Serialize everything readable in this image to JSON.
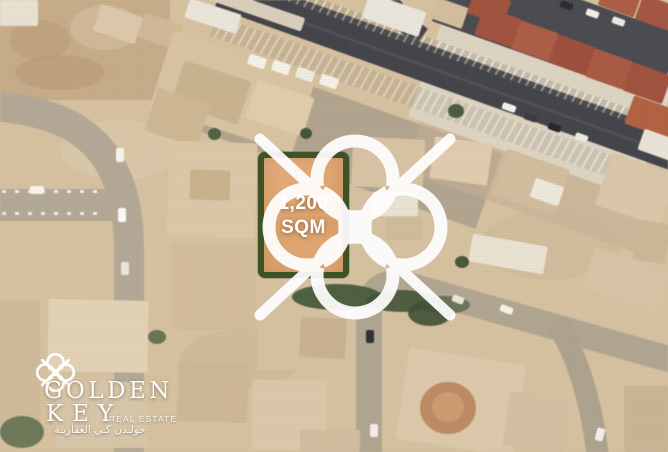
{
  "plot": {
    "area_line1": "1,200",
    "area_line2": "SQM"
  },
  "brand": {
    "name_line1": "GOLDEN",
    "name_line2": "KEY",
    "tagline": "REAL ESTATE",
    "arabic": "جولـدن كـي العقاريـة"
  },
  "colors": {
    "sand": "#d5c09f",
    "plot_fill": "#e1a876",
    "plot_border": "#3d5326",
    "watermark": "#ffffff",
    "text": "#ffffff",
    "road_light": "#b3a893",
    "road_dark": "#434449",
    "roof_red": "#a85540",
    "vegetation": "#4d5f3e"
  },
  "map": {
    "grounds": [
      {
        "t": "rect",
        "x": 0,
        "y": 0,
        "w": 170,
        "h": 100,
        "c": "#c7ab85",
        "n": "dirt-lot"
      },
      {
        "t": "ellipse",
        "x": 10,
        "y": 20,
        "w": 60,
        "h": 40,
        "c": "#bfa077",
        "o": 0.7
      },
      {
        "t": "ellipse",
        "x": 70,
        "y": 5,
        "w": 70,
        "h": 45,
        "c": "#d2bb97",
        "o": 0.8
      },
      {
        "t": "ellipse",
        "x": 15,
        "y": 55,
        "w": 90,
        "h": 35,
        "c": "#b89871",
        "o": 0.5
      },
      {
        "t": "ellipse",
        "x": 60,
        "y": 120,
        "w": 120,
        "h": 60,
        "c": "#dccaaa",
        "o": 0.6
      },
      {
        "t": "ellipse",
        "x": 180,
        "y": 330,
        "w": 120,
        "h": 60,
        "c": "#cbb390",
        "o": 0.5
      },
      {
        "t": "ellipse",
        "x": 480,
        "y": 210,
        "w": 140,
        "h": 70,
        "c": "#cdb896",
        "o": 0.5
      },
      {
        "t": "rect",
        "x": 210,
        "y": 50,
        "w": 310,
        "h": 80,
        "c": "#ab9f8a",
        "r": 19.5,
        "to": "lt",
        "o": 0.85,
        "n": "parking-area"
      },
      {
        "t": "rect",
        "x": 430,
        "y": 95,
        "w": 250,
        "h": 80,
        "c": "#c4b193",
        "r": 19.5,
        "to": "lt",
        "o": 0.6
      },
      {
        "t": "rect",
        "x": 455,
        "y": -15,
        "w": 240,
        "h": 140,
        "c": "#ddd3c0",
        "r": 19.5,
        "to": "lt",
        "n": "compound-ground"
      },
      {
        "t": "rect",
        "x": 455,
        "y": -45,
        "w": 240,
        "h": 70,
        "c": "#4a4b50",
        "r": 19.5,
        "to": "lt",
        "n": "parking-lot-dark"
      }
    ],
    "roads": [
      {
        "d": "M -6 106 C 40 110 86 122 110 164 C 124 189 129 216 129 252 L 129 458",
        "c": "#b3a893",
        "w": 30,
        "n": "curved-street-left"
      },
      {
        "d": "M -4 205 L 118 205",
        "c": "#b3a893",
        "w": 32,
        "n": "street-left-horizontal"
      },
      {
        "d": "M 221 -10 L 702 162",
        "c": "#434449",
        "w": 37,
        "n": "main-road"
      },
      {
        "d": "M 384 -8 C 392 8 404 24 422 37",
        "c": "#44454a",
        "w": 20,
        "n": "main-road-fork"
      },
      {
        "d": "M 240 0 L 700 164",
        "c": "#585960",
        "w": 3,
        "o": 0.6,
        "n": "main-road-wear"
      },
      {
        "d": "M 369 452 L 369 308",
        "c": "#b0a58f",
        "w": 26,
        "n": "street-vertical"
      },
      {
        "d": "M 369 316 C 369 292 380 280 404 284 L 672 360",
        "c": "#b0a58f",
        "w": 26,
        "n": "street-diagonal"
      },
      {
        "d": "M 556 322 C 576 352 592 402 598 458",
        "c": "#ada28c",
        "w": 22,
        "n": "street-branch"
      }
    ],
    "features": [
      {
        "t": "rect",
        "x": 233,
        "y": -32,
        "w": 470,
        "h": 13,
        "r": 19.5,
        "to": "lt",
        "o": 0.75,
        "g": "repeating-linear-gradient(100deg, rgba(255,255,255,0.55) 0 2px, rgba(110,100,85,0.3) 2px 8px)",
        "n": "wall-stripes"
      },
      {
        "t": "rect",
        "x": 217,
        "y": 15,
        "w": 480,
        "h": 22,
        "r": 19.5,
        "to": "lt",
        "o": 0.5,
        "g": "repeating-linear-gradient(100deg, rgba(255,255,255,0.5) 0 2px, rgba(110,100,85,0.3) 2px 8px)",
        "n": "wall-stripes"
      },
      {
        "t": "rect",
        "x": 2,
        "y": 190,
        "w": 100,
        "h": 3,
        "o": 0.8,
        "g": "repeating-linear-gradient(90deg, #ffffff 0 4px, transparent 4px 13px)",
        "n": "parking-dashes"
      },
      {
        "t": "rect",
        "x": 2,
        "y": 212,
        "w": 100,
        "h": 3,
        "o": 0.8,
        "g": "repeating-linear-gradient(90deg, #ffffff 0 4px, transparent 4px 13px)",
        "n": "parking-dashes"
      },
      {
        "t": "rect",
        "x": 0,
        "y": 0,
        "w": 38,
        "h": 26,
        "c": "#e8e1d1",
        "n": "building"
      },
      {
        "t": "rect",
        "x": 96,
        "y": 10,
        "w": 44,
        "h": 28,
        "c": "#dcc7a7",
        "r": 18,
        "n": "building"
      },
      {
        "t": "rect",
        "x": 140,
        "y": 18,
        "w": 40,
        "h": 26,
        "c": "#d0b892",
        "r": 18,
        "n": "building"
      },
      {
        "t": "rect",
        "x": 186,
        "y": 6,
        "w": 54,
        "h": 20,
        "c": "#eae5d8",
        "r": 18,
        "n": "building-shed"
      },
      {
        "t": "rect",
        "x": 196,
        "y": 0,
        "w": 110,
        "h": 14,
        "c": "#d8cdb9",
        "r": 19,
        "n": "building"
      },
      {
        "t": "rect",
        "x": 158,
        "y": 52,
        "w": 150,
        "h": 80,
        "c": "#d8c29e",
        "r": 18,
        "n": "building-compound"
      },
      {
        "t": "rect",
        "x": 176,
        "y": 70,
        "w": 70,
        "h": 45,
        "c": "#c9b28b",
        "r": 18,
        "n": "building"
      },
      {
        "t": "rect",
        "x": 250,
        "y": 88,
        "w": 60,
        "h": 40,
        "c": "#e0cca9",
        "r": 18,
        "n": "building"
      },
      {
        "t": "rect",
        "x": 150,
        "y": 95,
        "w": 55,
        "h": 45,
        "c": "#cfb790",
        "r": 18,
        "n": "building"
      },
      {
        "t": "rect",
        "x": 248,
        "y": 56,
        "w": 18,
        "h": 11,
        "c": "#f3f0e7",
        "r": 19,
        "n": "container"
      },
      {
        "t": "rect",
        "x": 272,
        "y": 62,
        "w": 18,
        "h": 11,
        "c": "#f3f0e7",
        "r": 19,
        "n": "container"
      },
      {
        "t": "rect",
        "x": 296,
        "y": 69,
        "w": 18,
        "h": 11,
        "c": "#eeebe0",
        "r": 19,
        "n": "container"
      },
      {
        "t": "rect",
        "x": 320,
        "y": 76,
        "w": 18,
        "h": 11,
        "c": "#f3f0e7",
        "r": 19,
        "n": "container"
      },
      {
        "t": "rect",
        "x": 364,
        "y": 2,
        "w": 60,
        "h": 26,
        "c": "#e9e5d9",
        "r": 19,
        "n": "building-warehouse"
      },
      {
        "t": "rect",
        "x": 432,
        "y": 2,
        "w": 34,
        "h": 22,
        "c": "#d3bd9c",
        "r": 19,
        "n": "building"
      },
      {
        "t": "rect",
        "x": 470,
        "y": -6,
        "w": 38,
        "h": 26,
        "c": "#a5513b",
        "r": 19.5,
        "n": "roof"
      },
      {
        "t": "rect",
        "x": 478,
        "y": 12,
        "w": 40,
        "h": 30,
        "c": "#a5513b",
        "r": 19.5,
        "n": "roof"
      },
      {
        "t": "rect",
        "x": 515,
        "y": 26,
        "w": 40,
        "h": 30,
        "c": "#b05c42",
        "r": 19.5,
        "n": "roof"
      },
      {
        "t": "rect",
        "x": 552,
        "y": 40,
        "w": 40,
        "h": 30,
        "c": "#a24e38",
        "r": 19.5,
        "n": "roof"
      },
      {
        "t": "rect",
        "x": 589,
        "y": 54,
        "w": 40,
        "h": 30,
        "c": "#ad5840",
        "r": 19.5,
        "n": "roof"
      },
      {
        "t": "rect",
        "x": 626,
        "y": 68,
        "w": 42,
        "h": 30,
        "c": "#a5513b",
        "r": 19.5,
        "n": "roof"
      },
      {
        "t": "rect",
        "x": 601,
        "y": -14,
        "w": 38,
        "h": 26,
        "c": "#b05c42",
        "r": 19.5,
        "n": "roof"
      },
      {
        "t": "rect",
        "x": 638,
        "y": 0,
        "w": 38,
        "h": 26,
        "c": "#a85540",
        "r": 19.5,
        "n": "roof"
      },
      {
        "t": "rect",
        "x": 628,
        "y": 102,
        "w": 46,
        "h": 30,
        "c": "#b5603f",
        "r": 19.5,
        "n": "roof"
      },
      {
        "t": "rect",
        "x": 640,
        "y": 134,
        "w": 36,
        "h": 22,
        "c": "#e8e3d6",
        "r": 19.5,
        "n": "building"
      },
      {
        "t": "rect",
        "x": 432,
        "y": 140,
        "w": 58,
        "h": 42,
        "c": "#e0cbab",
        "r": 8,
        "n": "building"
      },
      {
        "t": "rect",
        "x": 498,
        "y": 158,
        "w": 66,
        "h": 48,
        "c": "#d2bc9b",
        "r": 19,
        "n": "building"
      },
      {
        "t": "rect",
        "x": 532,
        "y": 182,
        "w": 30,
        "h": 20,
        "c": "#ece7db",
        "r": 19,
        "n": "building"
      },
      {
        "t": "rect",
        "x": 602,
        "y": 162,
        "w": 68,
        "h": 55,
        "c": "#dac5a5",
        "r": 19,
        "n": "building"
      },
      {
        "t": "rect",
        "x": 636,
        "y": 222,
        "w": 32,
        "h": 40,
        "c": "#cdb694",
        "r": 10,
        "n": "building"
      },
      {
        "t": "rect",
        "x": 352,
        "y": 138,
        "w": 72,
        "h": 50,
        "c": "#d8c2a1",
        "r": 3,
        "n": "building"
      },
      {
        "t": "rect",
        "x": 372,
        "y": 192,
        "w": 46,
        "h": 24,
        "c": "#e9e2d2",
        "n": "building"
      },
      {
        "t": "rect",
        "x": 386,
        "y": 218,
        "w": 36,
        "h": 22,
        "c": "#d0ba98",
        "n": "building"
      },
      {
        "t": "rect",
        "x": 168,
        "y": 142,
        "w": 88,
        "h": 95,
        "c": "#dcc6a5",
        "r": 2,
        "n": "building"
      },
      {
        "t": "rect",
        "x": 190,
        "y": 170,
        "w": 40,
        "h": 30,
        "c": "#cab28a",
        "r": 2,
        "n": "building"
      },
      {
        "t": "rect",
        "x": 172,
        "y": 244,
        "w": 84,
        "h": 86,
        "c": "#d2bb9a",
        "r": 1,
        "n": "building"
      },
      {
        "t": "rect",
        "x": 258,
        "y": 300,
        "w": 92,
        "h": 70,
        "c": "#d6c09f",
        "r": 1,
        "n": "building"
      },
      {
        "t": "rect",
        "x": 300,
        "y": 318,
        "w": 46,
        "h": 40,
        "c": "#c9b18d",
        "r": 3,
        "n": "building"
      },
      {
        "t": "rect",
        "x": 48,
        "y": 300,
        "w": 100,
        "h": 72,
        "c": "#e3d1b3",
        "r": 1,
        "n": "building"
      },
      {
        "t": "rect",
        "x": 56,
        "y": 382,
        "w": 92,
        "h": 66,
        "c": "#d8c5a6",
        "n": "building"
      },
      {
        "t": "rect",
        "x": 0,
        "y": 300,
        "w": 40,
        "h": 140,
        "c": "#cfb997",
        "n": "building"
      },
      {
        "t": "rect",
        "x": 178,
        "y": 362,
        "w": 70,
        "h": 60,
        "c": "#cdb695",
        "r": 2,
        "n": "building"
      },
      {
        "t": "rect",
        "x": 252,
        "y": 380,
        "w": 74,
        "h": 70,
        "c": "#dbc7a8",
        "r": 1,
        "n": "building"
      },
      {
        "t": "rect",
        "x": 300,
        "y": 430,
        "w": 60,
        "h": 22,
        "c": "#d2bc9c",
        "n": "building"
      },
      {
        "t": "rect",
        "x": 470,
        "y": 240,
        "w": 76,
        "h": 28,
        "c": "#e9e2d2",
        "r": 10,
        "n": "building"
      },
      {
        "t": "rect",
        "x": 402,
        "y": 356,
        "w": 118,
        "h": 92,
        "c": "#dcc8a9",
        "r": 9,
        "n": "building-villa"
      },
      {
        "t": "ellipse",
        "x": 420,
        "y": 382,
        "w": 56,
        "h": 52,
        "c": "#c08a5f",
        "n": "circular-court"
      },
      {
        "t": "ellipse",
        "x": 432,
        "y": 392,
        "w": 32,
        "h": 30,
        "c": "#cf9a6c",
        "n": "circular-court-inner"
      },
      {
        "t": "rect",
        "x": 506,
        "y": 396,
        "w": 62,
        "h": 54,
        "c": "#d3bf9f",
        "r": 9,
        "n": "building"
      },
      {
        "t": "rect",
        "x": 624,
        "y": 386,
        "w": 44,
        "h": 66,
        "c": "#c9b392",
        "n": "building"
      },
      {
        "t": "rect",
        "x": 586,
        "y": 258,
        "w": 80,
        "h": 44,
        "c": "#d7c2a2",
        "r": 19,
        "n": "building"
      },
      {
        "t": "ellipse",
        "x": 292,
        "y": 284,
        "w": 90,
        "h": 26,
        "c": "#4d5f3e",
        "n": "trees"
      },
      {
        "t": "ellipse",
        "x": 366,
        "y": 290,
        "w": 70,
        "h": 22,
        "c": "#415335",
        "o": 0.9,
        "n": "trees"
      },
      {
        "t": "ellipse",
        "x": 420,
        "y": 296,
        "w": 50,
        "h": 18,
        "c": "#556844",
        "o": 0.8,
        "n": "trees"
      },
      {
        "t": "ellipse",
        "x": 408,
        "y": 300,
        "w": 44,
        "h": 26,
        "c": "#3f5034",
        "o": 0.9,
        "n": "trees"
      },
      {
        "t": "ellipse",
        "x": 448,
        "y": 104,
        "w": 16,
        "h": 14,
        "c": "#4a5c3b",
        "n": "tree"
      },
      {
        "t": "ellipse",
        "x": 208,
        "y": 128,
        "w": 13,
        "h": 12,
        "c": "#50623f",
        "n": "tree"
      },
      {
        "t": "ellipse",
        "x": 300,
        "y": 128,
        "w": 12,
        "h": 11,
        "c": "#43553a",
        "n": "tree"
      },
      {
        "t": "ellipse",
        "x": 455,
        "y": 256,
        "w": 14,
        "h": 12,
        "c": "#46583a",
        "n": "tree"
      },
      {
        "t": "ellipse",
        "x": 0,
        "y": 416,
        "w": 44,
        "h": 32,
        "c": "#5c6d4a",
        "o": 0.85,
        "n": "trees"
      },
      {
        "t": "ellipse",
        "x": 148,
        "y": 330,
        "w": 18,
        "h": 14,
        "c": "#4f6140",
        "o": 0.8,
        "n": "tree"
      },
      {
        "t": "rect",
        "x": 116,
        "y": 148,
        "w": 8,
        "h": 14,
        "c": "#f5f3ec",
        "n": "car"
      },
      {
        "t": "rect",
        "x": 118,
        "y": 208,
        "w": 8,
        "h": 14,
        "c": "#fbfaf5",
        "n": "car"
      },
      {
        "t": "rect",
        "x": 121,
        "y": 262,
        "w": 8,
        "h": 13,
        "c": "#e8e5dc",
        "n": "car"
      },
      {
        "t": "rect",
        "x": 30,
        "y": 186,
        "w": 14,
        "h": 8,
        "c": "#f6f4ed",
        "n": "car"
      },
      {
        "t": "rect",
        "x": 502,
        "y": 104,
        "w": 14,
        "h": 7,
        "c": "#f2f0e9",
        "r": 19.5,
        "n": "car"
      },
      {
        "t": "rect",
        "x": 524,
        "y": 114,
        "w": 13,
        "h": 7,
        "c": "#3a3b3f",
        "r": 19.5,
        "n": "car"
      },
      {
        "t": "rect",
        "x": 548,
        "y": 124,
        "w": 13,
        "h": 7,
        "c": "#26272b",
        "r": 19.5,
        "n": "car"
      },
      {
        "t": "rect",
        "x": 575,
        "y": 134,
        "w": 13,
        "h": 7,
        "c": "#ebe8e0",
        "r": 19.5,
        "n": "car"
      },
      {
        "t": "rect",
        "x": 560,
        "y": 2,
        "w": 13,
        "h": 7,
        "c": "#2c2d31",
        "r": 19.5,
        "n": "car"
      },
      {
        "t": "rect",
        "x": 586,
        "y": 10,
        "w": 13,
        "h": 7,
        "c": "#f0eee6",
        "r": 19.5,
        "n": "car"
      },
      {
        "t": "rect",
        "x": 612,
        "y": 18,
        "w": 13,
        "h": 7,
        "c": "#e9e7df",
        "r": 19.5,
        "n": "car"
      },
      {
        "t": "rect",
        "x": 500,
        "y": 306,
        "w": 13,
        "h": 7,
        "c": "#f4f2ea",
        "r": 21,
        "n": "car"
      },
      {
        "t": "rect",
        "x": 452,
        "y": 296,
        "w": 12,
        "h": 7,
        "c": "#e8e5da",
        "r": 21,
        "n": "car"
      },
      {
        "t": "rect",
        "x": 596,
        "y": 428,
        "w": 8,
        "h": 13,
        "c": "#f2f0e8",
        "r": 15,
        "n": "car"
      },
      {
        "t": "rect",
        "x": 366,
        "y": 330,
        "w": 8,
        "h": 13,
        "c": "#2f3034",
        "n": "car"
      },
      {
        "t": "rect",
        "x": 370,
        "y": 424,
        "w": 8,
        "h": 13,
        "c": "#f0eee6",
        "n": "car"
      }
    ]
  }
}
